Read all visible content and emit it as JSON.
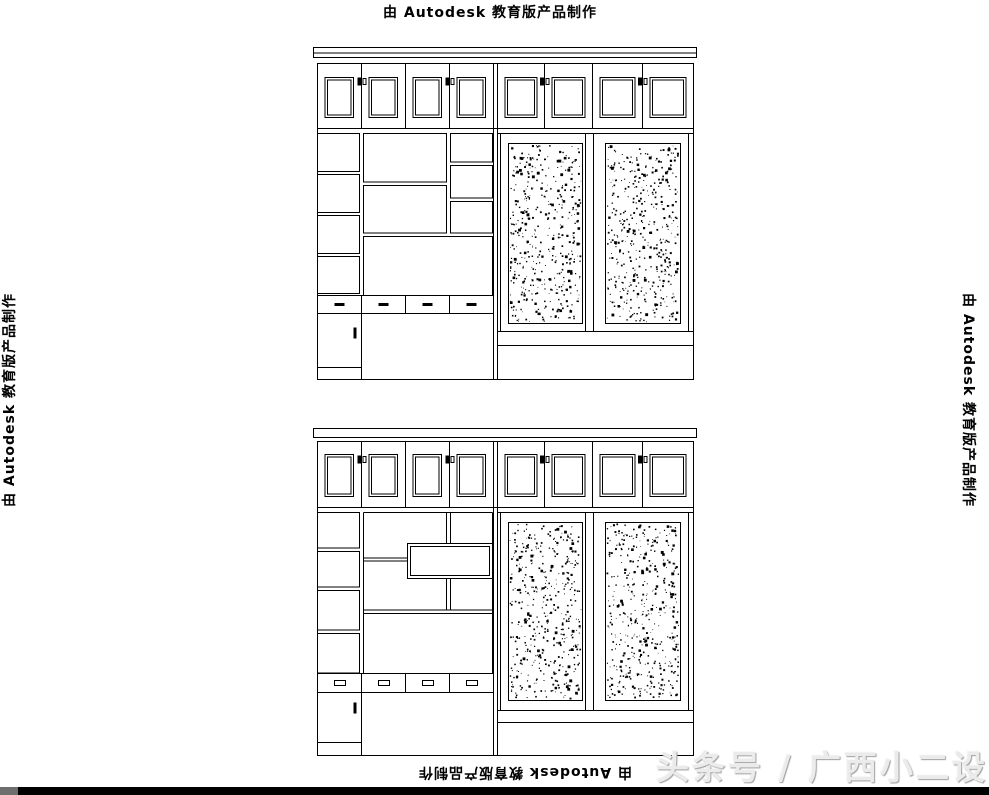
{
  "edu_watermark": {
    "text": "由 Autodesk 教育版产品制作"
  },
  "brand_watermark": {
    "text": "头条号 / 广西小二设计"
  },
  "colors": {
    "line": "#000000",
    "background": "#ffffff",
    "brand_text": "#ebebeb",
    "brand_shadow": "#9e9e9e",
    "bottom_bar": "#000000",
    "bottom_bar_left_accent": "#6e6e6e"
  }
}
